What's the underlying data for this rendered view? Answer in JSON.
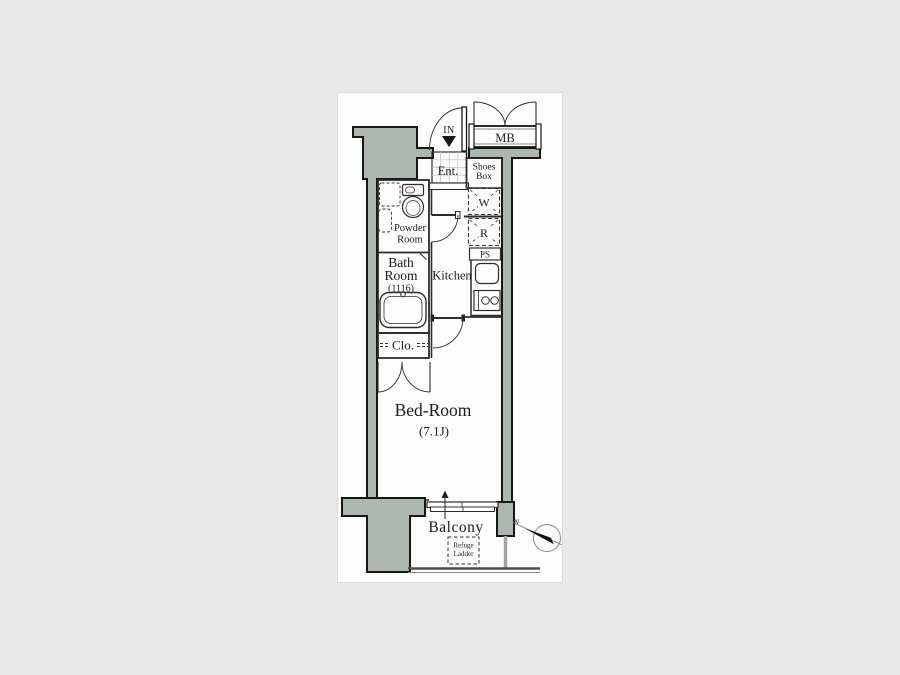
{
  "plan": {
    "type": "apartment-floor-plan",
    "labels": {
      "entrance_direction": "IN",
      "meter_box": "MB",
      "entrance": "Ent.",
      "shoes_box_line1": "Shoes",
      "shoes_box_line2": "Box",
      "washer": "W",
      "refrigerator": "R",
      "pipe_space": "PS",
      "powder_room_line1": "Powder",
      "powder_room_line2": "Room",
      "bath_line1": "Bath",
      "bath_line2": "Room",
      "bath_size": "(1116)",
      "kitchen": "Kitchen",
      "closet": "Clo.",
      "bedroom": "Bed-Room",
      "bedroom_size": "(7.1J)",
      "balcony": "Balcony",
      "refuge_line1": "Refuge",
      "refuge_line2": "Ladder",
      "compass_north": "N"
    },
    "colors": {
      "page_background": "#e9e9e9",
      "card_background": "#fdfdfd",
      "wall_fill": "#aeb6b0",
      "outline": "#161616",
      "text": "#1b1b1b"
    }
  }
}
